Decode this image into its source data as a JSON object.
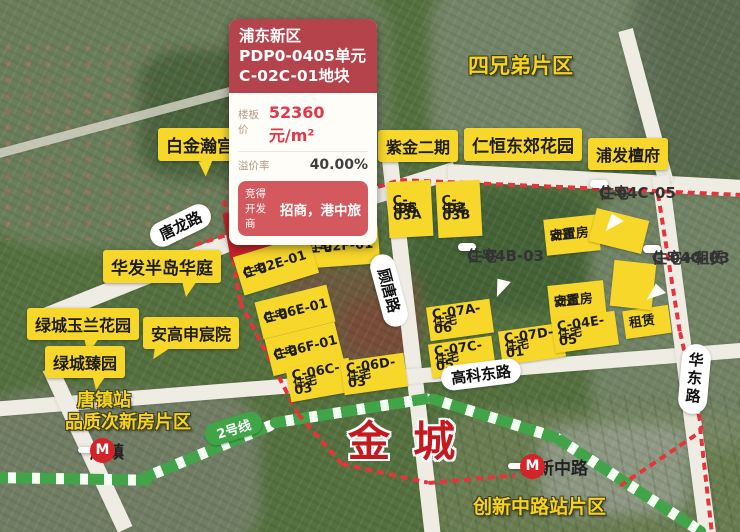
{
  "info_panel": {
    "region": "浦东新区",
    "unit": "PDP0-0405单元",
    "plot": "C-02C-01地块",
    "floor_price_label": "楼板价",
    "floor_price_value": "52360元/m²",
    "premium_rate_label": "溢价率",
    "premium_rate_value": "40.00%",
    "developer_label": "竞得开发商",
    "developer_value": "招商，港中旅"
  },
  "districts": {
    "si_xiong_di": "四兄弟片区",
    "tang_zhen_station_line1": "唐镇站",
    "tang_zhen_station_line2": "品质次新房片区",
    "chuang_xin_block": "创新中路站片区",
    "jin_cheng": "金城"
  },
  "communities": {
    "bai_jin_han_gong": "白金瀚宫",
    "zi_jin_er_qi": "紫金二期",
    "ren_heng_dong_jiao": "仁恒东郊花园",
    "pu_fa_tan_fu": "浦发檀府",
    "hua_fa_ban_dao": "华发半岛华庭",
    "lv_cheng_yu_lan": "绿城玉兰花园",
    "an_gao_shen_chen": "安高申宸院",
    "lv_cheng_zhen_yuan": "绿城臻园"
  },
  "roads": {
    "tang_long_lu": "唐龙路",
    "gu_tang_lu": "顾唐路",
    "gao_ke_dong_lu": "高科东路",
    "hua_dong_lu": "华东路"
  },
  "metro": {
    "line_label": "2号线",
    "station_tangzhen": "唐镇",
    "station_chuangxin": "创新中路",
    "logo_letter": "M"
  },
  "parcels": [
    {
      "type": "住宅",
      "code": "C-02C-01"
    },
    {
      "type": "住宅",
      "code": "C-02D-01"
    },
    {
      "type": "住宅",
      "code": "C-02F-01"
    },
    {
      "type": "住宅",
      "code": "C-02E-01"
    },
    {
      "type": "住宅",
      "code": "C-06E-01"
    },
    {
      "type": "住宅",
      "code": "C-06F-01"
    },
    {
      "type": "住宅",
      "code": "C-06C-03"
    },
    {
      "type": "住宅",
      "code": "C-06D-03"
    },
    {
      "type": "住宅",
      "code": "C-03A",
      "code2": "-06"
    },
    {
      "type": "住宅",
      "code": "C-03B",
      "code2": "-02"
    },
    {
      "type": "动迁",
      "code": "安置房"
    },
    {
      "type": "动迁",
      "code": "安置房"
    },
    {
      "type": "住宅",
      "code": "C-07A-06"
    },
    {
      "type": "住宅",
      "code": "C-07C-05"
    },
    {
      "type": "住宅",
      "code": "C-07D-01"
    },
    {
      "type": "住宅",
      "code": "C-04E-05"
    },
    {
      "type": "租赁",
      "code": ""
    }
  ],
  "white_callouts": [
    {
      "line1": "住宅",
      "line2": "C-04B-03"
    },
    {
      "line1": "住宅",
      "line2": "C-04C-05"
    },
    {
      "line1": "住宅+租赁",
      "line2": "C-04G-03"
    }
  ],
  "colors": {
    "parcel_yellow": "#f8d72b",
    "parcel_red": "#c4242b",
    "boundary_red": "#e8333a",
    "metro_green": "#42a449",
    "panel_header_red": "#b5434b",
    "price_red": "#e2364a",
    "jincheng_red": "#c4191f"
  }
}
